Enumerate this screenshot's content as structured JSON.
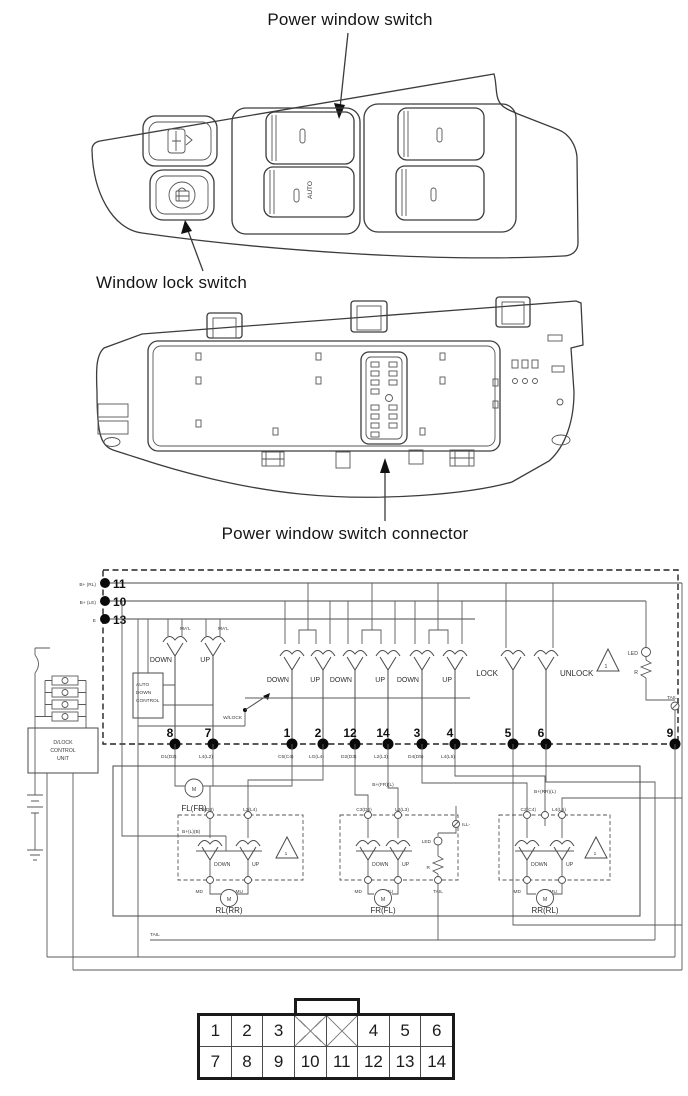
{
  "figure": {
    "front_label": "Power window switch",
    "lock_label": "Window lock switch",
    "connector_label": "Power window switch connector",
    "auto_text": "AUTO"
  },
  "schematic": {
    "left_pins": [
      {
        "num": "11",
        "label": "B+ (RL)"
      },
      {
        "num": "10",
        "label": "B+ (LE)"
      },
      {
        "num": "13",
        "label": "E"
      }
    ],
    "bottom_pins": [
      {
        "num": "8",
        "wire": "D1(D2)"
      },
      {
        "num": "7",
        "wire": "L4(L2)"
      },
      {
        "num": "1",
        "wire": "C5(C4)"
      },
      {
        "num": "2",
        "wire": "LG(L4)"
      },
      {
        "num": "12",
        "wire": "D2(D3)"
      },
      {
        "num": "14",
        "wire": "L2(L3)"
      },
      {
        "num": "3",
        "wire": "D4(D5)"
      },
      {
        "num": "4",
        "wire": "L4(L5)"
      },
      {
        "num": "5",
        "wire": ""
      },
      {
        "num": "6",
        "wire": ""
      },
      {
        "num": "9",
        "wire": ""
      }
    ],
    "driver": {
      "manual": "MA'L",
      "down": "DOWN",
      "up": "UP"
    },
    "auto_down_control": {
      "l1": "AUTO",
      "l2": "DOWN",
      "l3": "CONTROL"
    },
    "w_lock": "W/LOCK",
    "lock": "LOCK",
    "unlock": "UNLOCK",
    "led": "LED",
    "r": "R",
    "tail": "TAIL",
    "ill": "ILL-",
    "warn": "1",
    "d_lock_unit": {
      "l1": "D/LOCK",
      "l2": "CONTROL",
      "l3": "UNIT"
    },
    "front_motor": {
      "m": "M",
      "label": "FL(FR)"
    },
    "motor_boxes": [
      {
        "wire_left": "C3(D3)",
        "wire_right": "L3(L4)",
        "b_label": "B+(L)(B)",
        "down": "DOWN",
        "up": "UP",
        "md": "MD",
        "mu": "MU",
        "m": "M",
        "label": "RL(RR)"
      },
      {
        "wire_left": "C3(D2)",
        "wire_right": "L2(L3)",
        "b_label": "B+(FR)(L)",
        "down": "DOWN",
        "up": "UP",
        "md": "MD",
        "mu": "MU",
        "m": "M",
        "label": "FR(FL)"
      },
      {
        "wire_left": "C2(C4)",
        "wire_right": "L4(L5)",
        "b_label": "B+(RR)(L)",
        "down": "DOWN",
        "up": "UP",
        "md": "MD",
        "mu": "MU",
        "m": "M",
        "label": "RR(RL)"
      }
    ],
    "tail_bottom": "TAIL"
  },
  "connector_table": {
    "row1": [
      "1",
      "2",
      "3",
      "",
      "",
      "4",
      "5",
      "6"
    ],
    "row2": [
      "7",
      "8",
      "9",
      "10",
      "11",
      "12",
      "13",
      "14"
    ]
  }
}
